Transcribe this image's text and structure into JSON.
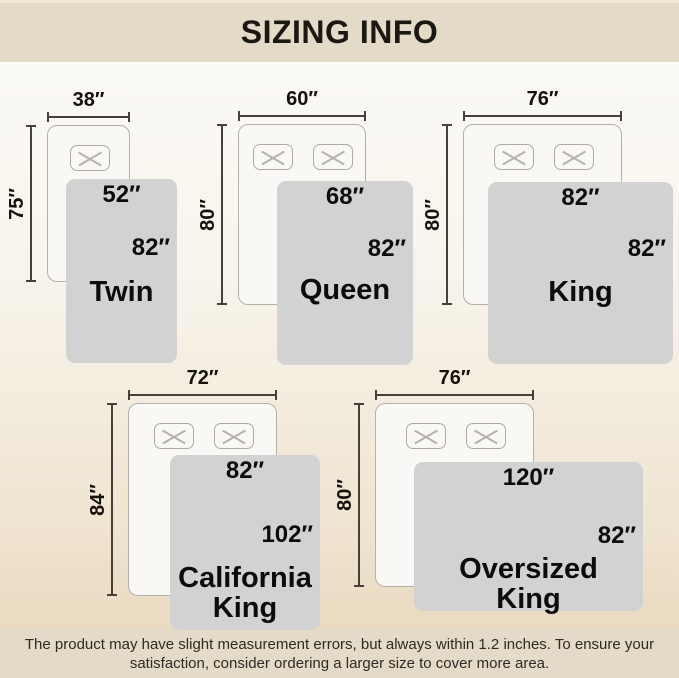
{
  "title": "SIZING INFO",
  "footer_lines": [
    "The product may have slight measurement errors, but always within 1.2 inches. To ensure your",
    "satisfaction, consider ordering a larger size to cover more area."
  ],
  "colors": {
    "band_bg": "#e4dac8",
    "band_text": "#1b1712",
    "background_top": "#fcfbf9",
    "background_bottom": "#e7d5b9",
    "bed_fill": "#f9f8f5",
    "bed_border": "#b4b1ab",
    "blanket": "#d2d2d3",
    "dim_line": "#46403a",
    "label_text": "#15110c"
  },
  "icons": {
    "pillow": "pillow-icon",
    "pillow_cross": "cross-icon"
  },
  "diagrams": [
    {
      "id": "twin",
      "name_lines": [
        "Twin"
      ],
      "bed_width": "38″",
      "bed_height": "75″",
      "blanket_width": "52″",
      "blanket_height": "82″",
      "pillows": 1,
      "geo": {
        "bed": [
          47,
          125,
          83,
          157
        ],
        "blanket": [
          66,
          179,
          111,
          184
        ],
        "side_dy": 55,
        "name_dy": 98
      }
    },
    {
      "id": "queen",
      "name_lines": [
        "Queen"
      ],
      "bed_width": "60″",
      "bed_height": "80″",
      "blanket_width": "68″",
      "blanket_height": "82″",
      "pillows": 2,
      "geo": {
        "bed": [
          238,
          124,
          128,
          181
        ],
        "blanket": [
          277,
          181,
          136,
          184
        ],
        "side_dy": 54,
        "name_dy": 94
      }
    },
    {
      "id": "king",
      "name_lines": [
        "King"
      ],
      "bed_width": "76″",
      "bed_height": "80″",
      "blanket_width": "82″",
      "blanket_height": "82″",
      "pillows": 2,
      "geo": {
        "bed": [
          463,
          124,
          159,
          181
        ],
        "blanket": [
          488,
          182,
          185,
          182
        ],
        "side_dy": 53,
        "name_dy": 95
      }
    },
    {
      "id": "california-king",
      "name_lines": [
        "California",
        "King"
      ],
      "bed_width": "72″",
      "bed_height": "84″",
      "blanket_width": "82″",
      "blanket_height": "102″",
      "pillows": 2,
      "geo": {
        "bed": [
          128,
          403,
          149,
          193
        ],
        "blanket": [
          170,
          455,
          150,
          175
        ],
        "side_dy": 66,
        "name_dy": 108
      }
    },
    {
      "id": "oversized-king",
      "name_lines": [
        "Oversized",
        "King"
      ],
      "bed_width": "76″",
      "bed_height": "80″",
      "blanket_width": "120″",
      "blanket_height": "82″",
      "pillows": 2,
      "geo": {
        "bed": [
          375,
          403,
          159,
          184
        ],
        "blanket": [
          414,
          462,
          229,
          149
        ],
        "side_dy": 60,
        "name_dy": 92
      }
    }
  ]
}
